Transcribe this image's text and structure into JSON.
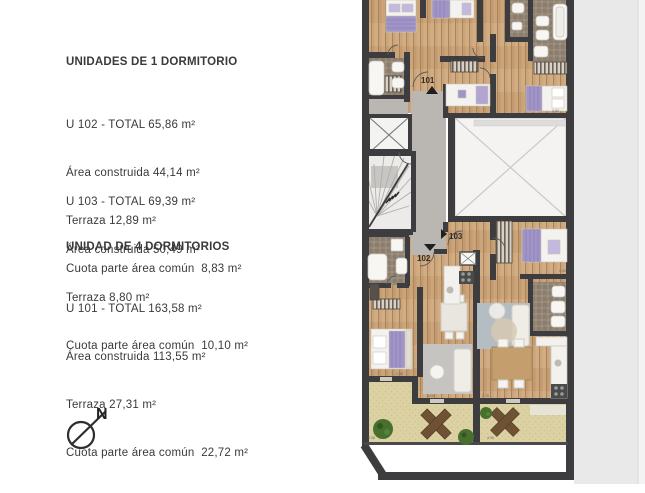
{
  "legend": {
    "section1_heading": "UNIDADES DE 1 DORMITORIO",
    "section2_heading": "UNIDAD DE 4 DORMITORIOS",
    "units": [
      {
        "title": "U 102 - TOTAL 65,86 m²",
        "area": "Área construida 44,14 m²",
        "terrace": "Terraza 12,89 m²",
        "common": "Cuota parte área común  8,83 m²"
      },
      {
        "title": "U 103 - TOTAL 69,39 m²",
        "area": "Área construida 50,49 m²",
        "terrace": "Terraza 8,80 m²",
        "common": "Cuota parte área común  10,10 m²"
      },
      {
        "title": "U 101 - TOTAL 163,58 m²",
        "area": "Área construida 113,55 m²",
        "terrace": "Terraza 27,31 m²",
        "common": "Cuota parte área común  22,72 m²"
      }
    ]
  },
  "compass": {
    "north_label": "N"
  },
  "plan": {
    "unit_tags": {
      "u101": "101",
      "u102": "102",
      "u103": "103"
    },
    "dims": {
      "d1": "2.80",
      "d2": "2.40",
      "d3": "1.36",
      "d4": "3.06",
      "d5": "1.76",
      "d6": "4.40",
      "d7": "4.08"
    },
    "colors": {
      "wall": "#3d3c3e",
      "wood": "#cba47a",
      "tile": "#968879",
      "terrace": "#dbd1a2",
      "corridor": "#bab7b2",
      "courtyard": "#f4f3f1",
      "bed_accent": "#a194c6"
    }
  }
}
